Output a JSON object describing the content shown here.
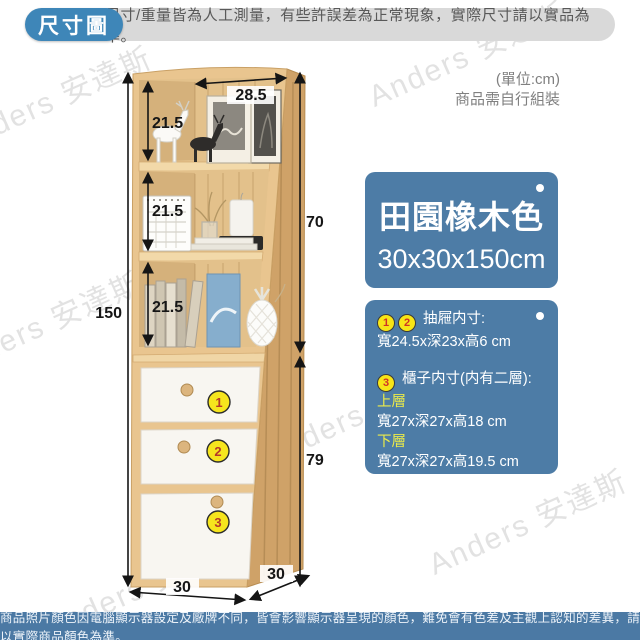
{
  "header": {
    "badge": "尺寸圖",
    "note": "尺寸/重量皆為人工測量，有些許誤差為正常現象，實際尺寸請以實品為準。"
  },
  "unit_note": {
    "line1": "(單位:cm)",
    "line2": "商品需自行組裝"
  },
  "product": {
    "color_name": "田園橡木色",
    "overall_size": "30x30x150cm"
  },
  "specs": {
    "drawer": {
      "badge_1": "1",
      "badge_2": "2",
      "title": "抽屜内寸:",
      "size": "寬24.5x深23x高6 cm"
    },
    "cabinet": {
      "badge": "3",
      "title": "櫃子内寸(内有二層):",
      "upper_label": "上層",
      "upper_size": "寬27x深27x高18 cm",
      "lower_label": "下層",
      "lower_size": "寬27x深27x高19.5 cm"
    }
  },
  "dimensions": {
    "total_height": "150",
    "shelf_heights": [
      "21.5",
      "21.5",
      "21.5"
    ],
    "top_width": "28.5",
    "upper_section_height": "70",
    "lower_section_height": "79",
    "base_width": "30",
    "base_depth": "30"
  },
  "cabinet_badges": [
    "1",
    "2",
    "3"
  ],
  "watermark": "Anders 安達斯",
  "footer": "商品照片顏色因電腦顯示器設定及廠牌不同，皆會影響顯示器呈現的顏色，難免會有色差及主觀上認知的差異，請以實際商品顏色為準。",
  "colors": {
    "accent_blue": "#3e86b8",
    "panel_blue": "#4d7ca6",
    "badge_yellow": "#f7e517",
    "highlight_yellow": "#eaea4a",
    "wood_light": "#e9c58f",
    "wood_dark": "#cfa268"
  }
}
